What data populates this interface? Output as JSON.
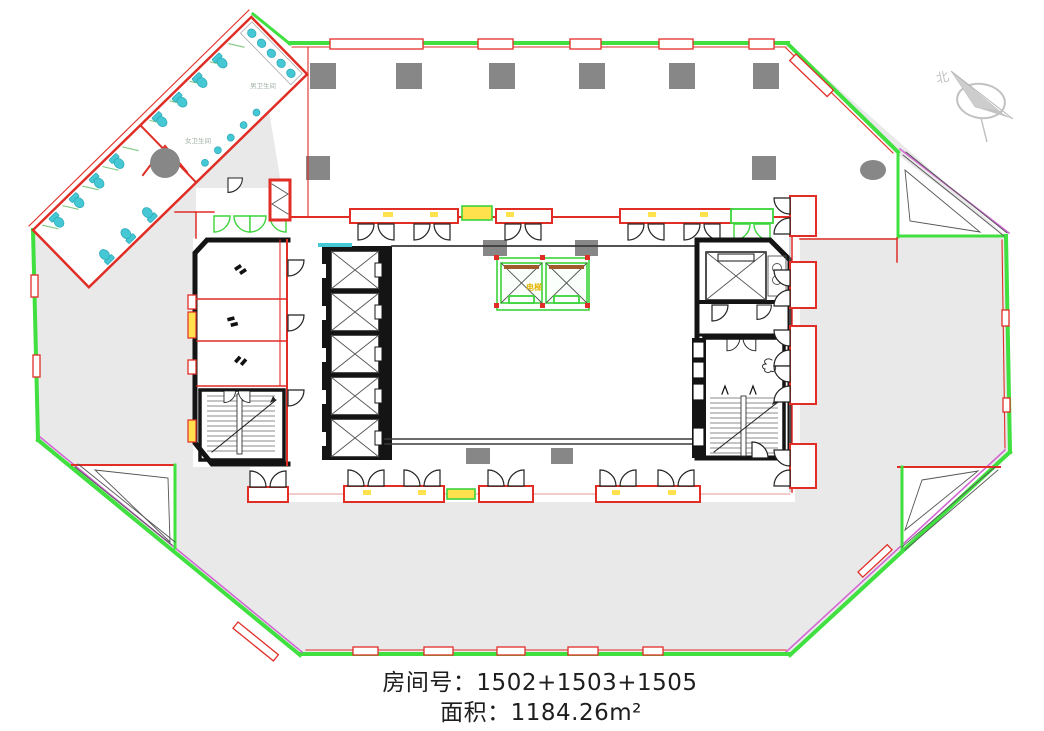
{
  "info": {
    "room_label": "房间号：",
    "room_value": "1502+1503+1505",
    "area_label": "面积：",
    "area_value": "1184.26m²"
  },
  "compass": {
    "north_label": "北"
  },
  "plan_labels": {
    "men_restroom": "男卫生间",
    "women_restroom": "女卫生间",
    "elevator": "电梯"
  },
  "colors": {
    "facade_green": "#3fe03f",
    "wall_red": "#e02d26",
    "accent_magenta": "#d266d2",
    "highlight_yellow": "#ffe14d",
    "fixture_cyan": "#45c8d4",
    "floor_gray": "#e9e9e9",
    "column_gray": "#878787",
    "core_black": "#141414",
    "door_green": "#3bd43b",
    "text_dark": "#1e1e1e",
    "compass_gray": "#c2c2c2"
  }
}
